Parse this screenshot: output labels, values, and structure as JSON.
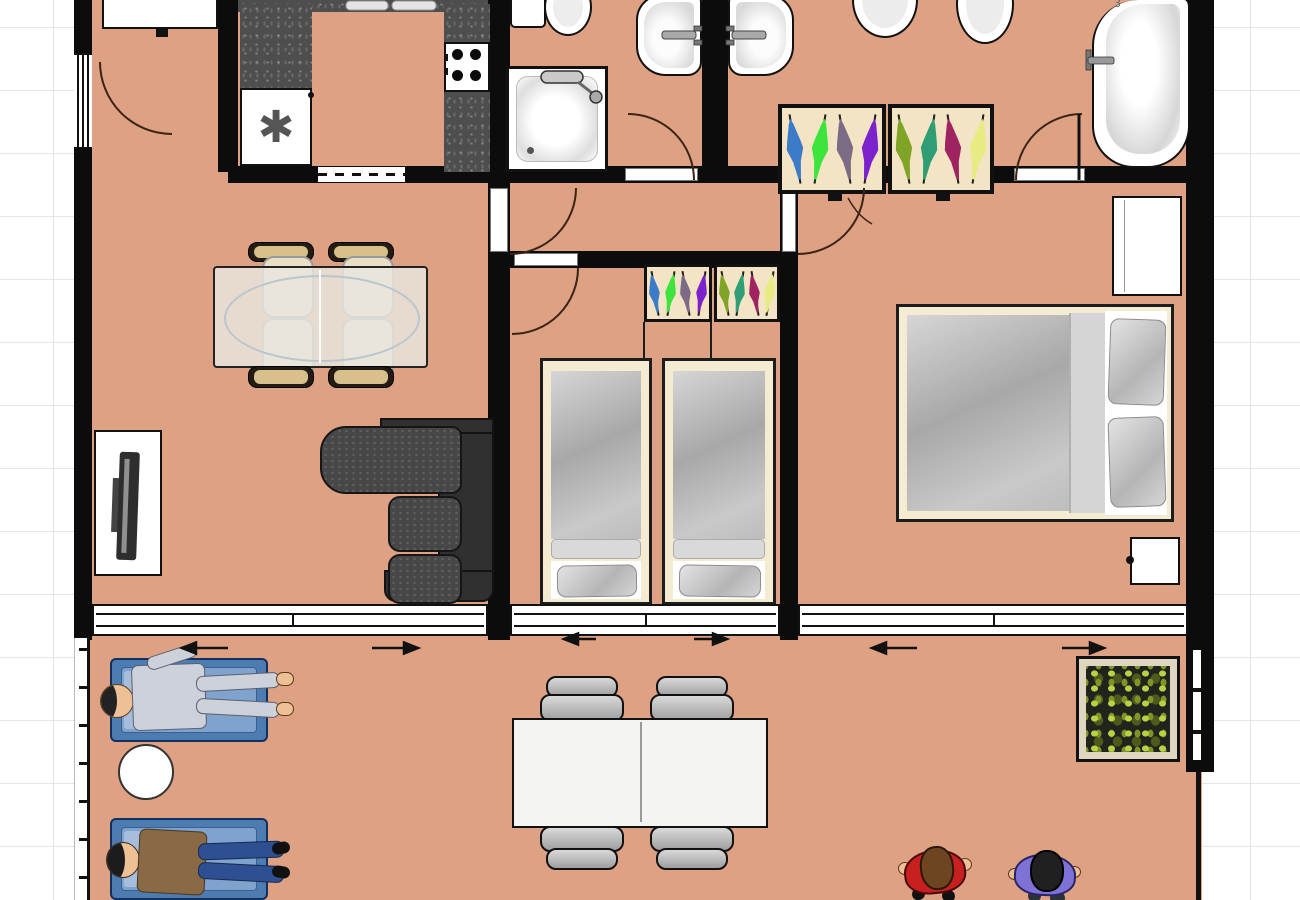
{
  "labels": {
    "bathtub_number": "3",
    "freezer_symbol": "✱"
  },
  "colors": {
    "floor": "#dfa183",
    "wall": "#0c0c0c",
    "grid_line": "#e5e5e5",
    "counter": "#4e4e4e",
    "wardrobe_interior": "#f4e4c6",
    "bed_frame": "#f3ecd3",
    "sofa": "#3d3d3d",
    "lounger_blue": "#4d7cb0",
    "glass_table_outline": "#b9c6ce",
    "plant_foliage": "#8ea32c",
    "door_arc": "#3a2414",
    "arrow": "#111111",
    "person_red_shirt": "#c81f1f",
    "person_purple_shirt": "#7e72d6",
    "person_brown_top": "#8a6a45",
    "person_jeans": "#2e4f91",
    "person_gray_outfit": "#ccd1da"
  },
  "wardrobes": {
    "master_sections": [
      [
        "#3b7bc8",
        "#3ce43c",
        "#7b6b85",
        "#7b22cc"
      ],
      [
        "#7fa426",
        "#2f9e74",
        "#9e2360",
        "#e6eb83"
      ]
    ],
    "kids_sections": [
      [
        "#3b7bc8",
        "#3ce43c",
        "#7b6b85",
        "#7b22cc"
      ],
      [
        "#7fa426",
        "#2f9e74",
        "#9e2360",
        "#e6eb83"
      ]
    ]
  },
  "inventory": {
    "kitchen": [
      "countertop",
      "sink",
      "stove-4-burners",
      "freezer"
    ],
    "bathroom_1": [
      "toilet",
      "washbasin",
      "shower"
    ],
    "bathroom_2": [
      "washbasin",
      "toilet",
      "toilet",
      "bathtub"
    ],
    "living_room": [
      "glass-dining-table",
      "4-chairs",
      "tv-bench",
      "tv",
      "corner-sofa"
    ],
    "kids_bedroom": [
      "wardrobe",
      "single-bed",
      "single-bed"
    ],
    "master_bedroom": [
      "wardrobe",
      "dresser",
      "double-bed",
      "nightstand"
    ],
    "balcony": [
      "sun-lounger",
      "person-lying",
      "round-side-table",
      "sun-lounger",
      "person-lying",
      "outdoor-table",
      "4-chairs",
      "planter",
      "person-standing",
      "person-standing"
    ],
    "doors": [
      "entrance-door",
      "living-room-door",
      "kids-room-door",
      "bathroom-1-door",
      "ensuite-door",
      "master-bedroom-door",
      "sliding-door",
      "sliding-door",
      "sliding-door"
    ]
  }
}
